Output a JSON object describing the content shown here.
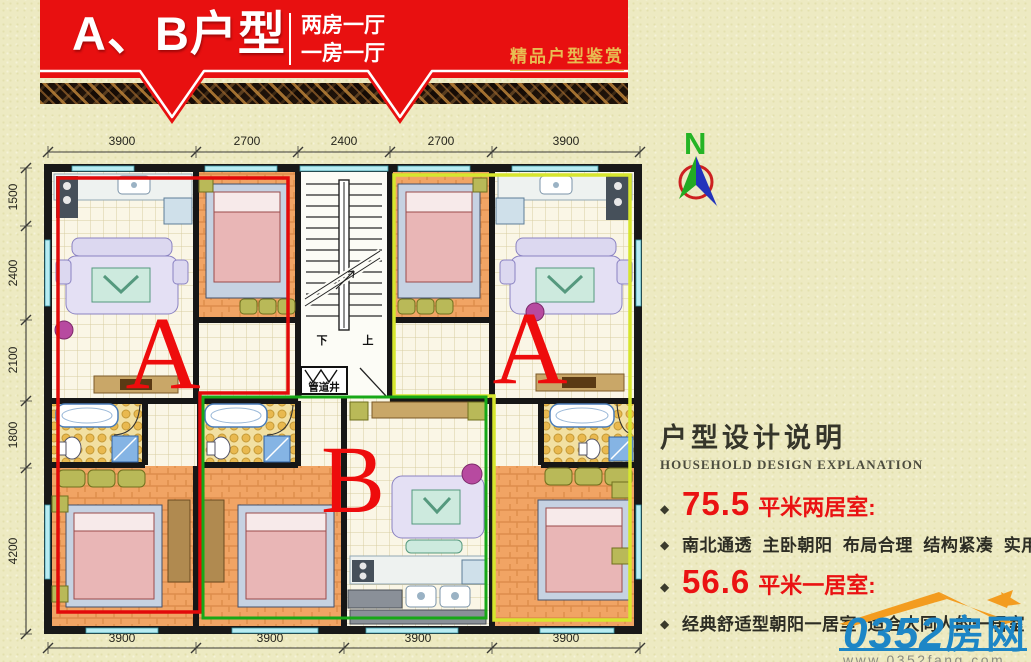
{
  "header": {
    "title": "A、B户型",
    "subtitle_line1": "两房一厅",
    "subtitle_line2": "一房一厅",
    "tagline": "精品户型鉴赏"
  },
  "compass": {
    "north_label": "N"
  },
  "plan": {
    "unit_label_left": "A",
    "unit_label_right": "A",
    "unit_label_bottom": "B",
    "pipe_shaft_label": "管道井",
    "stair_down_label": "下",
    "stair_up_label": "上",
    "dims_top": [
      "3900",
      "2700",
      "2400",
      "2700",
      "3900"
    ],
    "dims_left": [
      "1500",
      "2400",
      "2100",
      "1800",
      "4200"
    ],
    "dims_bottom": [
      "3900",
      "3900",
      "3900",
      "3900"
    ]
  },
  "explanation": {
    "title": "户型设计说明",
    "subtitle": "HOUSEHOLD DESIGN EXPLANATION",
    "bullet": "◆",
    "area1_value": "75.5",
    "area1_label": "平米两居室:",
    "desc1": "南北通透  主卧朝阳  布局合理  结构紧凑  实用性高",
    "area2_value": "56.6",
    "area2_label": "平米一居室:",
    "desc2": "经典舒适型朝阳一居室  适合大同人的一居室"
  },
  "logo": {
    "number": "0352",
    "name": "房网",
    "url": "www.0352fang.com"
  },
  "colors": {
    "banner_red": "#e81010",
    "tagline_gold": "#e8bc52",
    "unit_a_outline": "#e20a0a",
    "unit_b_outline": "#17a817",
    "unit_a2_outline": "#d6e62e",
    "highlight_red": "#ea1212",
    "logo_blue": "#1d86c6",
    "logo_orange": "#f39c1f"
  }
}
